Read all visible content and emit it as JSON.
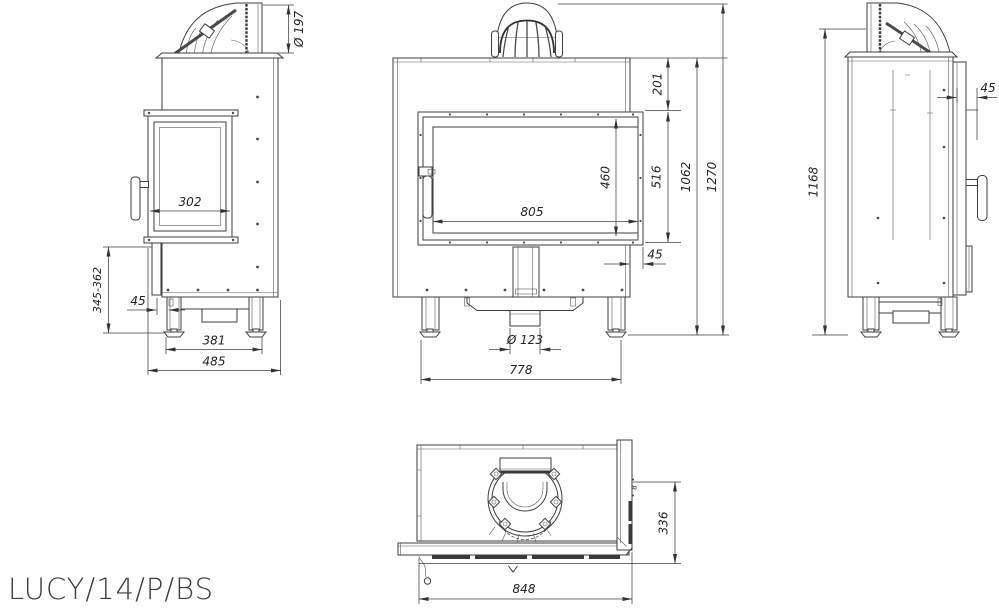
{
  "title": "LUCY/14/P/BS",
  "views": {
    "left_side": {
      "dims": {
        "flue_diameter": "Ø 197",
        "side_glass_width": "302",
        "floor_to_door_bottom": "345-362",
        "leg_offset": "45",
        "leg_spacing": "381",
        "total_depth": "485"
      }
    },
    "front": {
      "dims": {
        "top_section_height": "201",
        "glass_height": "460",
        "door_height": "516",
        "glass_width": "805",
        "frame_offset": "45",
        "body_height": "1062",
        "total_height": "1270",
        "air_inlet_diameter": "Ø 123",
        "leg_span": "778"
      }
    },
    "right_side": {
      "dims": {
        "frame_offset": "45",
        "flue_outlet_height": "1168"
      }
    },
    "top": {
      "dims": {
        "glass_thickness": "8",
        "depth": "336",
        "width": "848"
      }
    }
  }
}
